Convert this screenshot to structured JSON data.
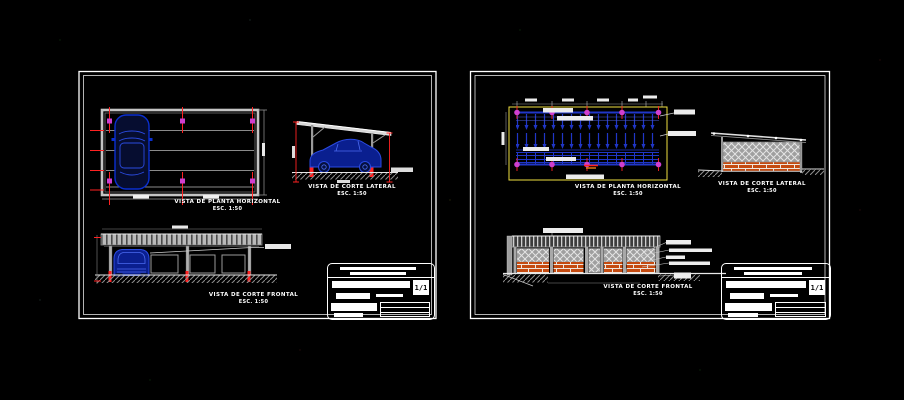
{
  "canvas": {
    "width": 904,
    "height": 400,
    "background": "#000000"
  },
  "palette": {
    "sheet_border": "#ffffff",
    "cad_gray": "#9d9d9d",
    "car_blue": "#0a2fd0",
    "column_magenta": "#cf3fcf",
    "dimension_red": "#ff2222",
    "boundary_yellow": "#f0e040",
    "brick_orange": "#c44a10",
    "structure_blue": "#2036c8"
  },
  "left_sheet": {
    "views": {
      "plan": {
        "title": "VISTA DE PLANTA HORIZONTAL",
        "scale": "ESC. 1:50"
      },
      "lateral": {
        "title": "VISTA DE CORTE LATERAL",
        "scale": "ESC. 1:50"
      },
      "front": {
        "title": "VISTA DE CORTE FRONTAL",
        "scale": "ESC. 1:50"
      }
    },
    "titleblock": {
      "page": "1/1"
    }
  },
  "right_sheet": {
    "views": {
      "plan": {
        "title": "VISTA DE PLANTA HORIZONTAL",
        "scale": "ESC. 1:50"
      },
      "lateral": {
        "title": "VISTA DE CORTE LATERAL",
        "scale": "ESC. 1:50"
      },
      "front": {
        "title": "VISTA DE CORTE FRONTAL",
        "scale": "ESC. 1:50"
      }
    },
    "titleblock": {
      "page": "1/1"
    }
  }
}
